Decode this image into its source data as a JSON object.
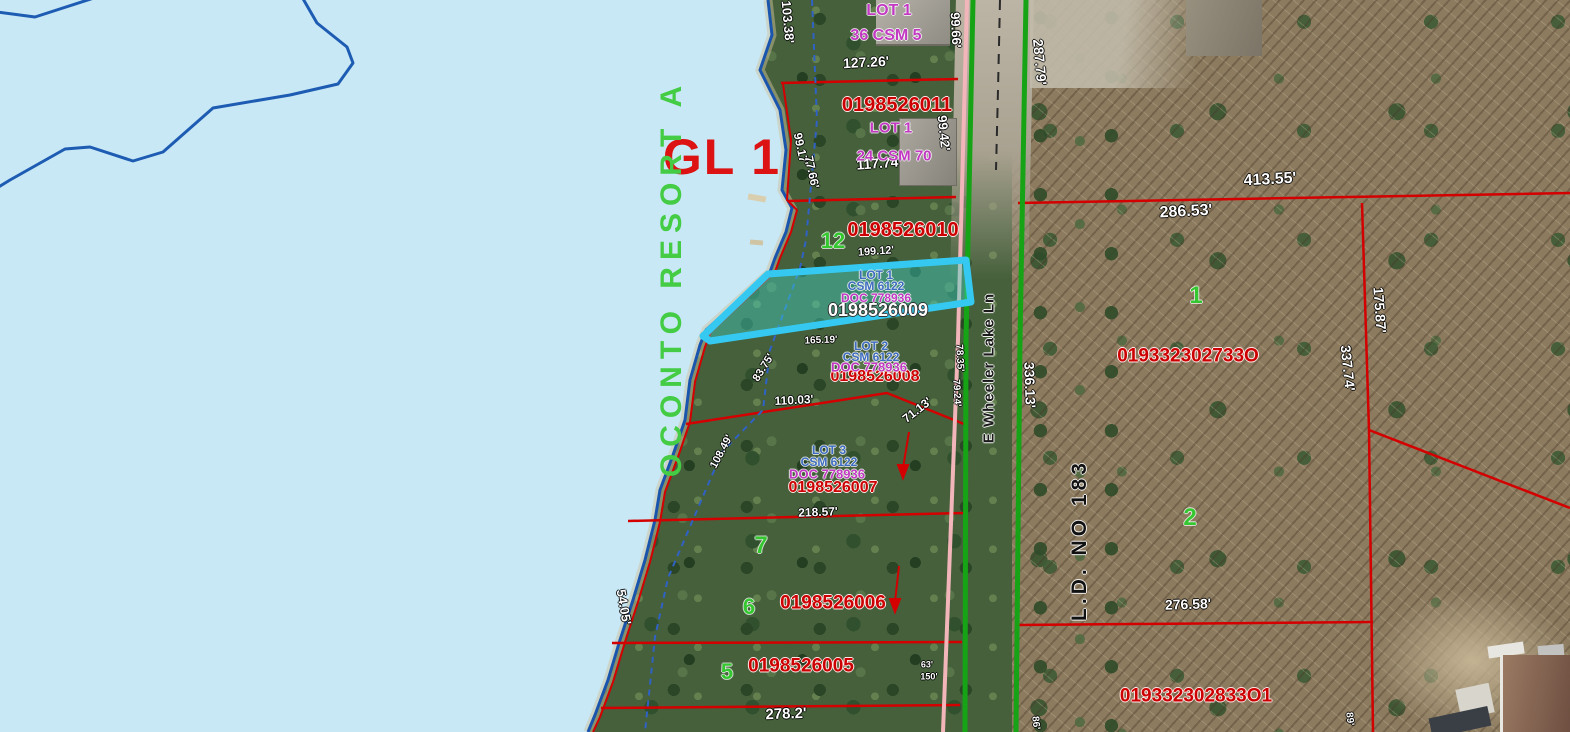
{
  "map": {
    "gl_label": "GL 1",
    "plat_name": "OCONTO RESORT A",
    "road_name": "E Wheeler Lake Ln",
    "ld_label": "L.D. NO 183",
    "selected_parcel": {
      "id": "0198526009",
      "lot": "LOT 1",
      "csm": "CSM 6122",
      "doc": "DOC 778936"
    },
    "colors": {
      "lake": "#c8e8f6",
      "shoreline": "#1a55ad",
      "parcel_line": "#d40000",
      "road_edge": "#16a416",
      "section_line": "#f2b6ba",
      "selection_stroke": "#35c9f2",
      "selection_fill": "rgba(64,214,200,0.42)",
      "parcel_id_text": "#cc0000",
      "lot_text_magenta": "#c238c2",
      "lot_text_blue": "#3e6cc0",
      "lot_number_green": "#35c72f",
      "gl_red": "#dd1212",
      "plat_green": "#44cc44"
    },
    "labels": [
      {
        "name": "dim-127-26",
        "text": "127.26'",
        "x": 866,
        "y": 62,
        "rot": -3,
        "cls": "dim",
        "fs": 14
      },
      {
        "name": "dim-103-38",
        "text": "103.38'",
        "x": 788,
        "y": 22,
        "rot": 85,
        "cls": "dim",
        "fs": 13
      },
      {
        "name": "dim-99-66",
        "text": "99.66'",
        "x": 956,
        "y": 30,
        "rot": 87,
        "cls": "dim",
        "fs": 13
      },
      {
        "name": "dim-287-79",
        "text": "287.79'",
        "x": 1040,
        "y": 62,
        "rot": 85,
        "cls": "dim",
        "fs": 14
      },
      {
        "name": "dim-117-74",
        "text": "117.74'",
        "x": 879,
        "y": 163,
        "rot": -4,
        "cls": "dim",
        "fs": 14
      },
      {
        "name": "dim-99-42",
        "text": "99.42'",
        "x": 944,
        "y": 133,
        "rot": 84,
        "cls": "dim",
        "fs": 13
      },
      {
        "name": "dim-99-17",
        "text": "99.17'",
        "x": 801,
        "y": 149,
        "rot": 78,
        "cls": "dim",
        "fs": 12
      },
      {
        "name": "dim-77-66",
        "text": "77.66'",
        "x": 812,
        "y": 172,
        "rot": 78,
        "cls": "dim",
        "fs": 12
      },
      {
        "name": "dim-199-12",
        "text": "199.12'",
        "x": 876,
        "y": 252,
        "rot": -4,
        "cls": "dim",
        "fs": 11
      },
      {
        "name": "dim-165-19",
        "text": "165.19'",
        "x": 821,
        "y": 341,
        "rot": -2,
        "cls": "dim",
        "fs": 10
      },
      {
        "name": "dim-83-75",
        "text": "83.75'",
        "x": 764,
        "y": 368,
        "rot": -58,
        "cls": "dim",
        "fs": 11
      },
      {
        "name": "dim-110-03",
        "text": "110.03'",
        "x": 794,
        "y": 400,
        "rot": -3,
        "cls": "dim",
        "fs": 12
      },
      {
        "name": "dim-71-13",
        "text": "71.13'",
        "x": 917,
        "y": 410,
        "rot": -38,
        "cls": "dim",
        "fs": 12
      },
      {
        "name": "dim-108-49",
        "text": "108.49'",
        "x": 722,
        "y": 452,
        "rot": -62,
        "cls": "dim",
        "fs": 11
      },
      {
        "name": "dim-218-57",
        "text": "218.57'",
        "x": 818,
        "y": 512,
        "rot": -2,
        "cls": "dim",
        "fs": 12
      },
      {
        "name": "dim-54-05",
        "text": "54.05'",
        "x": 624,
        "y": 607,
        "rot": 80,
        "cls": "dim",
        "fs": 13
      },
      {
        "name": "dim-78-35",
        "text": "78.35'",
        "x": 959,
        "y": 358,
        "rot": 87,
        "cls": "dim",
        "fs": 10
      },
      {
        "name": "dim-79-24",
        "text": "79.24'",
        "x": 956,
        "y": 393,
        "rot": 87,
        "cls": "dim",
        "fs": 10
      },
      {
        "name": "dim-278-2",
        "text": "278.2'",
        "x": 786,
        "y": 714,
        "rot": -2,
        "cls": "dim",
        "fs": 15
      },
      {
        "name": "dim-413-55",
        "text": "413.55'",
        "x": 1270,
        "y": 180,
        "rot": -3,
        "cls": "dim",
        "fs": 16
      },
      {
        "name": "dim-286-53",
        "text": "286.53'",
        "x": 1186,
        "y": 212,
        "rot": -3,
        "cls": "dim",
        "fs": 16
      },
      {
        "name": "dim-336-13",
        "text": "336.13'",
        "x": 1030,
        "y": 385,
        "rot": 88,
        "cls": "dim",
        "fs": 14
      },
      {
        "name": "dim-337-74",
        "text": "337.74'",
        "x": 1348,
        "y": 368,
        "rot": 84,
        "cls": "dim",
        "fs": 14
      },
      {
        "name": "dim-175-87",
        "text": "175.87'",
        "x": 1380,
        "y": 310,
        "rot": 86,
        "cls": "dim",
        "fs": 14
      },
      {
        "name": "dim-276-58",
        "text": "276.58'",
        "x": 1188,
        "y": 604,
        "rot": -2,
        "cls": "dim",
        "fs": 14
      },
      {
        "name": "dim-63",
        "text": "63'",
        "x": 927,
        "y": 665,
        "rot": 0,
        "cls": "dim",
        "fs": 9
      },
      {
        "name": "dim-150",
        "text": "150'",
        "x": 929,
        "y": 677,
        "rot": 0,
        "cls": "dim",
        "fs": 9
      },
      {
        "name": "dim-86",
        "text": "86'",
        "x": 1035,
        "y": 723,
        "rot": 84,
        "cls": "dim",
        "fs": 10
      },
      {
        "name": "dim-89",
        "text": "89'",
        "x": 1349,
        "y": 719,
        "rot": 84,
        "cls": "dim",
        "fs": 10
      },
      {
        "name": "parcel-id-0198526011",
        "text": "0198526011",
        "x": 897,
        "y": 105,
        "rot": 0,
        "cls": "pid",
        "fs": 20
      },
      {
        "name": "parcel-id-0198526010",
        "text": "0198526010",
        "x": 903,
        "y": 230,
        "rot": 0,
        "cls": "pid",
        "fs": 20
      },
      {
        "name": "parcel-id-0198526008",
        "text": "0198526008",
        "x": 875,
        "y": 377,
        "rot": 0,
        "cls": "pid",
        "fs": 16
      },
      {
        "name": "parcel-id-0198526007",
        "text": "0198526007",
        "x": 833,
        "y": 488,
        "rot": 0,
        "cls": "pid",
        "fs": 16
      },
      {
        "name": "parcel-id-0198526006",
        "text": "0198526006",
        "x": 833,
        "y": 603,
        "rot": 0,
        "cls": "pid",
        "fs": 19
      },
      {
        "name": "parcel-id-0198526005",
        "text": "0198526005",
        "x": 801,
        "y": 666,
        "rot": 0,
        "cls": "pid",
        "fs": 19
      },
      {
        "name": "parcel-id-019332302733O",
        "text": "019332302733O",
        "x": 1188,
        "y": 356,
        "rot": 0,
        "cls": "pid",
        "fs": 19
      },
      {
        "name": "parcel-id-019332302833O1",
        "text": "019332302833O1",
        "x": 1196,
        "y": 696,
        "rot": 0,
        "cls": "pid",
        "fs": 19
      },
      {
        "name": "parcel-id-0198526009-selected",
        "text": "0198526009",
        "x": 878,
        "y": 310,
        "rot": 0,
        "cls": "pidw",
        "fs": 18
      },
      {
        "name": "lot1-csm5-lot",
        "text": "LOT 1",
        "x": 889,
        "y": 11,
        "rot": 0,
        "cls": "mag",
        "fs": 16
      },
      {
        "name": "lot1-csm5",
        "text": "36 CSM 5",
        "x": 886,
        "y": 36,
        "rot": 0,
        "cls": "mag",
        "fs": 16
      },
      {
        "name": "lot1-csm70-lot",
        "text": "LOT 1",
        "x": 891,
        "y": 128,
        "rot": 0,
        "cls": "mag",
        "fs": 15
      },
      {
        "name": "lot1-csm70",
        "text": "24 CSM 70",
        "x": 894,
        "y": 156,
        "rot": 0,
        "cls": "mag",
        "fs": 15
      },
      {
        "name": "selected-lot-label",
        "text": "LOT 1",
        "x": 876,
        "y": 275,
        "rot": 0,
        "cls": "blu",
        "fs": 12
      },
      {
        "name": "selected-csm-label",
        "text": "CSM 6122",
        "x": 876,
        "y": 286,
        "rot": 0,
        "cls": "blu",
        "fs": 12
      },
      {
        "name": "selected-doc-label",
        "text": "DOC 778936",
        "x": 876,
        "y": 298,
        "rot": 0,
        "cls": "mag",
        "fs": 12
      },
      {
        "name": "lot2-label",
        "text": "LOT 2",
        "x": 871,
        "y": 346,
        "rot": 0,
        "cls": "blu",
        "fs": 12
      },
      {
        "name": "lot2-csm-label",
        "text": "CSM 6122",
        "x": 871,
        "y": 357,
        "rot": 0,
        "cls": "blu",
        "fs": 12
      },
      {
        "name": "lot2-doc-label",
        "text": "DOC 778936",
        "x": 869,
        "y": 367,
        "rot": 0,
        "cls": "mag",
        "fs": 13
      },
      {
        "name": "lot3-label",
        "text": "LOT 3",
        "x": 829,
        "y": 450,
        "rot": 0,
        "cls": "blu",
        "fs": 12
      },
      {
        "name": "lot3-csm-label",
        "text": "CSM 6122",
        "x": 829,
        "y": 462,
        "rot": 0,
        "cls": "blu",
        "fs": 12
      },
      {
        "name": "lot3-doc-label",
        "text": "DOC 778936",
        "x": 827,
        "y": 474,
        "rot": 0,
        "cls": "mag",
        "fs": 13
      },
      {
        "name": "lot-number-12",
        "text": "12",
        "x": 833,
        "y": 241,
        "rot": 0,
        "cls": "grn",
        "fs": 22
      },
      {
        "name": "lot-number-7",
        "text": "7",
        "x": 761,
        "y": 546,
        "rot": 0,
        "cls": "grn",
        "fs": 24
      },
      {
        "name": "lot-number-6",
        "text": "6",
        "x": 749,
        "y": 607,
        "rot": 0,
        "cls": "grn",
        "fs": 22
      },
      {
        "name": "lot-number-5",
        "text": "5",
        "x": 727,
        "y": 672,
        "rot": 0,
        "cls": "grn",
        "fs": 22
      },
      {
        "name": "lot-number-1",
        "text": "1",
        "x": 1196,
        "y": 296,
        "rot": 0,
        "cls": "grn",
        "fs": 24
      },
      {
        "name": "lot-number-2",
        "text": "2",
        "x": 1190,
        "y": 518,
        "rot": 0,
        "cls": "grn",
        "fs": 24
      }
    ]
  }
}
